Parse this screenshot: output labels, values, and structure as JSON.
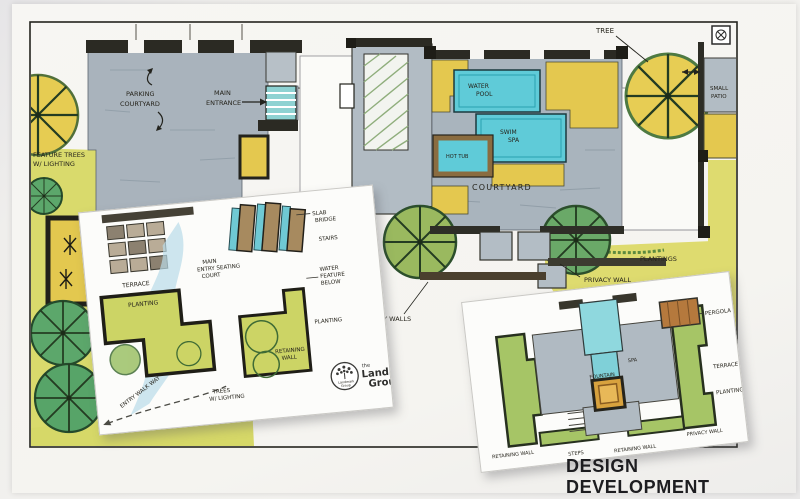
{
  "photo": {
    "caption": "DESIGN DEVELOPMENT"
  },
  "brand": {
    "the": "the",
    "name_line1": "Landmark",
    "name_line2": "Group",
    "emblem_line1": "Landmark",
    "emblem_line2": "Group"
  },
  "main_plan": {
    "left": {
      "parking_line1": "PARKING",
      "parking_line2": "COURTYARD",
      "entrance_line1": "MAIN",
      "entrance_line2": "ENTRANCE",
      "feature_line1": "FEATURE TREES",
      "feature_line2": "W/ LIGHTING"
    },
    "right": {
      "skylight": "SKYLIGHT",
      "tree": "TREE",
      "water_line1": "WATER",
      "water_line2": "POOL",
      "spa_line1": "SWIM",
      "spa_line2": "SPA",
      "hot_tub": "HOT TUB",
      "courtyard": "COURTYARD",
      "patio_line1": "SMALL",
      "patio_line2": "PATIO",
      "privacy_wall": "PRIVACY WALL",
      "plantings": "PLANTINGS",
      "privacy_walls": "PRIVACY WALLS"
    }
  },
  "inset_entry": {
    "terrace": "TERRACE",
    "planting_left": "PLANTING",
    "court_line1": "MAIN",
    "court_line2": "ENTRY SEATING",
    "court_line3": "COURT",
    "slab_line1": "SLAB",
    "slab_line2": "BRIDGE",
    "stairs": "STAIRS",
    "water_line1": "WATER",
    "water_line2": "FEATURE",
    "water_line3": "BELOW",
    "planting_right": "PLANTING",
    "retaining_line1": "RETAINING",
    "retaining_line2": "WALL",
    "trees_line1": "TREES",
    "trees_line2": "W/ LIGHTING",
    "walkway": "ENTRY WALK WAY"
  },
  "inset_court": {
    "pergola": "PERGOLA",
    "terrace": "TERRACE",
    "planting": "PLANTING",
    "retaining_left": "RETAINING WALL",
    "steps": "STEPS",
    "retaining_right": "RETAINING WALL",
    "privacy": "PRIVACY WALL",
    "fountain": "FOUNTAIN",
    "spa": "SPA"
  },
  "palette": {
    "water_cyan": "#5fcbd8",
    "planting_yellow": "#e4c84f",
    "lawn_green": "#d9da6c",
    "tree_green": "#5ca76b",
    "paving_gray": "#a9b3bc",
    "wall_dark": "#2b2a23",
    "slab_brown": "#a78a5f",
    "pergola_brown": "#b5793d",
    "fountain_orange": "#d8a23e"
  }
}
